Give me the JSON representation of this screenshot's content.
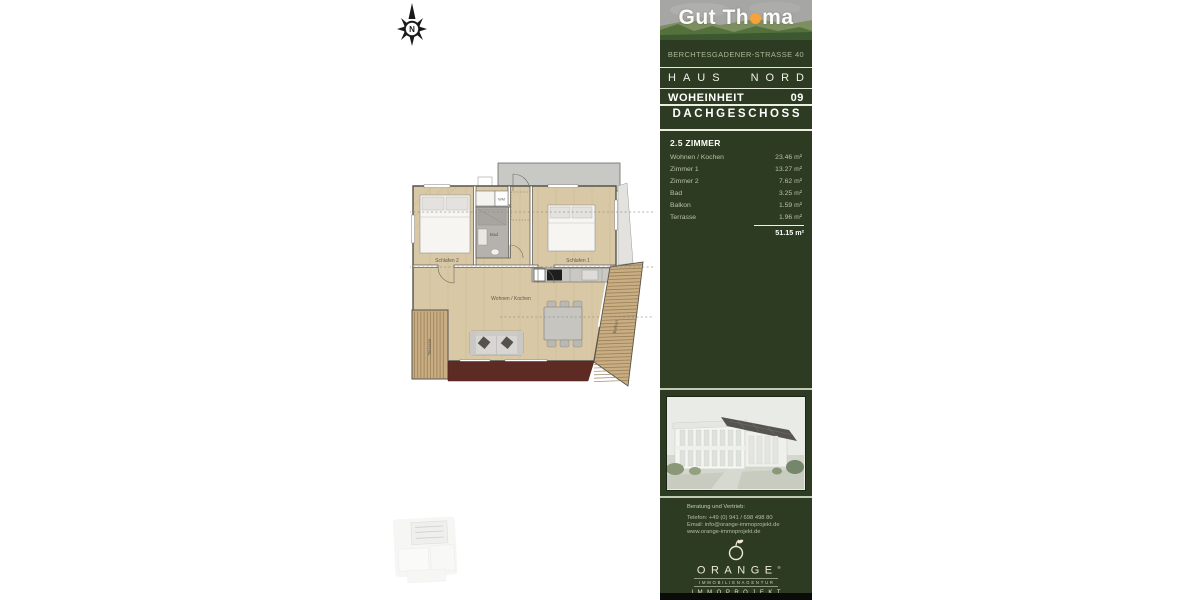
{
  "compass": {
    "label": "N"
  },
  "floorplan": {
    "schlafen2": "Schlafen 2",
    "schlafen1": "Schlafen 1",
    "bad": "Bad",
    "wm": "WM",
    "wohnen_kochen": "Wohnen / Kochen",
    "terrasse": "Terrasse",
    "balkon": "Balkon"
  },
  "panel": {
    "logo": {
      "name_start": "Gut Th",
      "name_end": "ma"
    },
    "address": "BERCHTESGADENER-STRASSE 40",
    "house_left": "HAUS",
    "house_right": "NORD",
    "unit_label": "WOHEINHEIT",
    "unit_number": "09",
    "floor_label": "DACHGESCHOSS",
    "rooms_title": "2.5 ZIMMER",
    "rooms": [
      {
        "label": "Wohnen / Kochen",
        "value": "23.46 m²"
      },
      {
        "label": "Zimmer 1",
        "value": "13.27 m²"
      },
      {
        "label": "Zimmer 2",
        "value": "7.62 m²"
      },
      {
        "label": "Bad",
        "value": "3.25 m²"
      },
      {
        "label": "Balkon",
        "value": "1.59 m²"
      },
      {
        "label": "Terrasse",
        "value": "1.96 m²"
      }
    ],
    "total": "51.15 m²",
    "contact": {
      "heading": "Beratung und Vertrieb:",
      "phone": "Telefon: +49 (0) 941 / 698 498 80",
      "email": "Email: info@orange-immoprojekt.de",
      "website": "www.orange-immoprojekt.de"
    },
    "agency": {
      "name": "ORANGE",
      "registered": "®",
      "subtitle": "IMMOBILIENAGENTUR",
      "brand": "IMMOPROJEKT"
    },
    "colors": {
      "panel_green": "#2e3b23",
      "accent_orange": "#f2a33c",
      "sage": "#b7c3a4",
      "maroon": "#5e2b24"
    }
  }
}
